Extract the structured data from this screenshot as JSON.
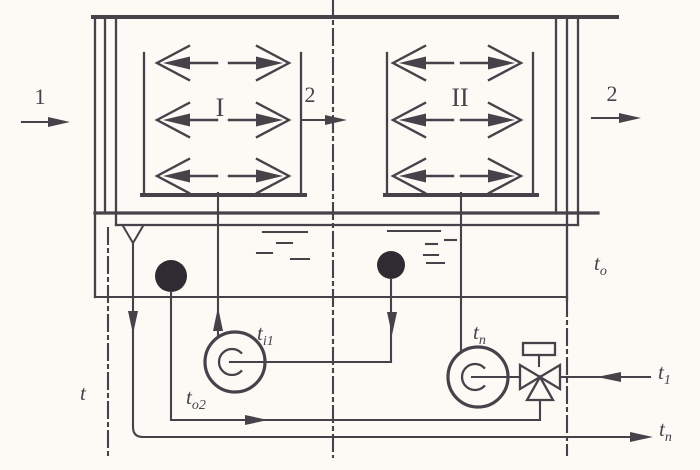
{
  "diagram": {
    "title": "Two-stage spray chamber (air washer) piping schematic",
    "colors": {
      "ink": "#46424a",
      "fill": "#2e2b33",
      "paper": "#fbfaf5"
    },
    "icons": [
      "spray-nozzle-icon",
      "pump-icon",
      "strainer-icon",
      "three-way-valve-icon",
      "funnel-drain-icon",
      "flow-arrow-icon",
      "water-level-icon"
    ],
    "labels": {
      "inlet_air": "1",
      "mid_air": "2",
      "outlet_air": "2",
      "chamber_1": "I",
      "chamber_2": "II",
      "t_boundary": {
        "base": "t",
        "sub": ""
      },
      "t_tank": {
        "base": "t",
        "sub": "o"
      },
      "t_i1": {
        "base": "t",
        "sub": "i1"
      },
      "t_o2": {
        "base": "t",
        "sub": "o2"
      },
      "t_pump2": {
        "base": "t",
        "sub": "n"
      },
      "t_fresh": {
        "base": "t",
        "sub": "1"
      },
      "t_out": {
        "base": "t",
        "sub": "n"
      }
    }
  }
}
